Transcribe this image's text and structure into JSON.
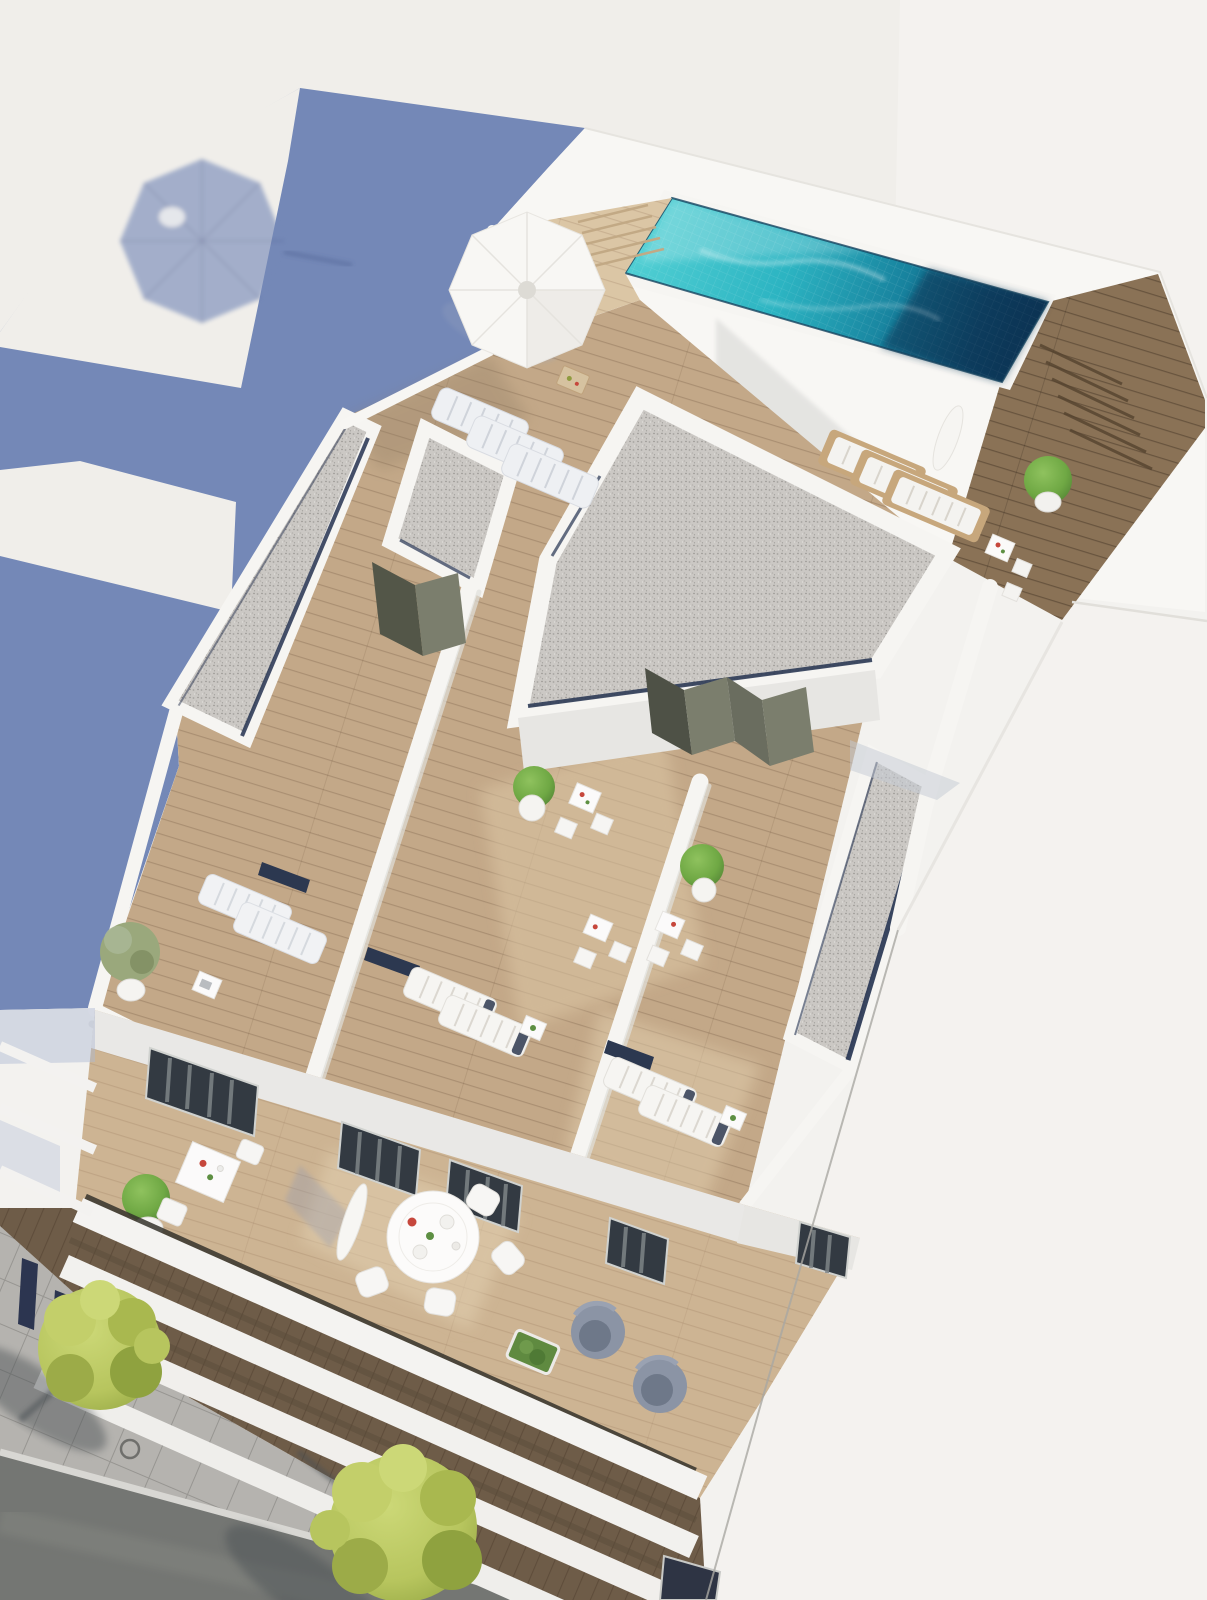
{
  "scene": {
    "type": "architectural-3d-render",
    "view": "aerial oblique view of a modern white apartment building",
    "features": [
      "rooftop infinity pool with turquoise mosaic tiles",
      "timber pool deck with steps",
      "gravel flat-roof strips with navy skylight gaps",
      "private roof terraces with sun loungers and bistro sets",
      "large cast shadow of the building on the ground",
      "umbrella shadow inside the lit wedge",
      "lower balcony floor with round dining set and lounge armchairs",
      "stacked white balcony slabs above the street",
      "sidewalk with pavers, two yellow-green trees and asphalt road"
    ],
    "counts": {
      "open-parasols": 2,
      "folded-parasols": 2,
      "sun-loungers": 12,
      "bistro-sets": 5,
      "round-dining-tables": 1,
      "lounge-armchairs": 2,
      "gravel-roofs": 4,
      "street-trees": 2,
      "potted-plants": 10
    }
  },
  "palette": {
    "bg": "#f0eeea",
    "bg-right": "#f4f2ef",
    "shadow": "#7488b7",
    "shadow-soft": "#8d9cc4",
    "building-white": "#f3f2ef",
    "building-lit": "#f8f7f4",
    "wall-shade": "#e7e6e3",
    "parapet": "#f6f5f2",
    "pool-aqua": "#4ecdd2",
    "pool-teal": "#2cb4c2",
    "pool-mid": "#17819d",
    "pool-deep": "#0d4a6b",
    "pool-navy": "#0a3352",
    "gravel": "#cbc8c4",
    "wood-light": "#dbc6a5",
    "wood-mid": "#c3a888",
    "wood-low": "#cdb493",
    "wood-dark": "#8a7256",
    "soffit": "#6e5c48",
    "navy-gap": "#243250",
    "door-olive": "#7b7e6d",
    "glass-dark": "#333a42",
    "curtain": "#7e8487",
    "asphalt": "#747673",
    "paver": "#b5b3af",
    "curb": "#d8d7d3",
    "tree-yellow": "#b7c55e",
    "tree-olive": "#8fa23f",
    "plant-green": "#6fa844",
    "plant-dark": "#4f7f33",
    "lounger-white": "#f4f3f0",
    "lounger-shade": "#eef0f3",
    "wood-frame": "#c7a77c",
    "armchair": "#8b94a5",
    "armchair-dark": "#6e7889",
    "red-accent": "#c6473c"
  }
}
